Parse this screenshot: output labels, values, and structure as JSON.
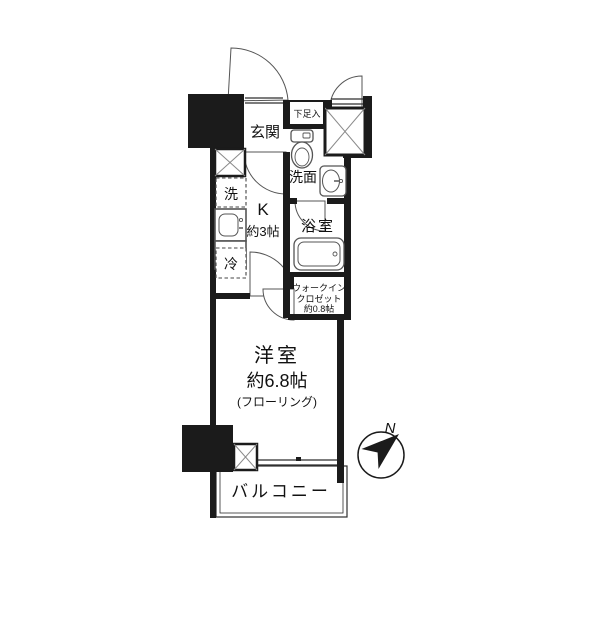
{
  "floorplan": {
    "rooms": {
      "genkan": {
        "label": "玄関"
      },
      "shoe_box": {
        "label": "下足入"
      },
      "washroom": {
        "label": "洗面"
      },
      "bathroom": {
        "label": "浴室"
      },
      "kitchen": {
        "label": "K",
        "size": "約3帖"
      },
      "washer": {
        "label": "洗"
      },
      "fridge": {
        "label": "冷"
      },
      "closet": {
        "lines": [
          "ウォークイン",
          "クロゼット",
          "約0.8帖"
        ]
      },
      "main_room": {
        "label": "洋室",
        "size": "約6.8帖",
        "note": "(フローリング)"
      },
      "balcony": {
        "label": "バルコニー"
      }
    },
    "compass": {
      "north_label": "N"
    },
    "colors": {
      "wall": "#1b1b1b",
      "line": "#555555",
      "background": "#ffffff"
    }
  }
}
